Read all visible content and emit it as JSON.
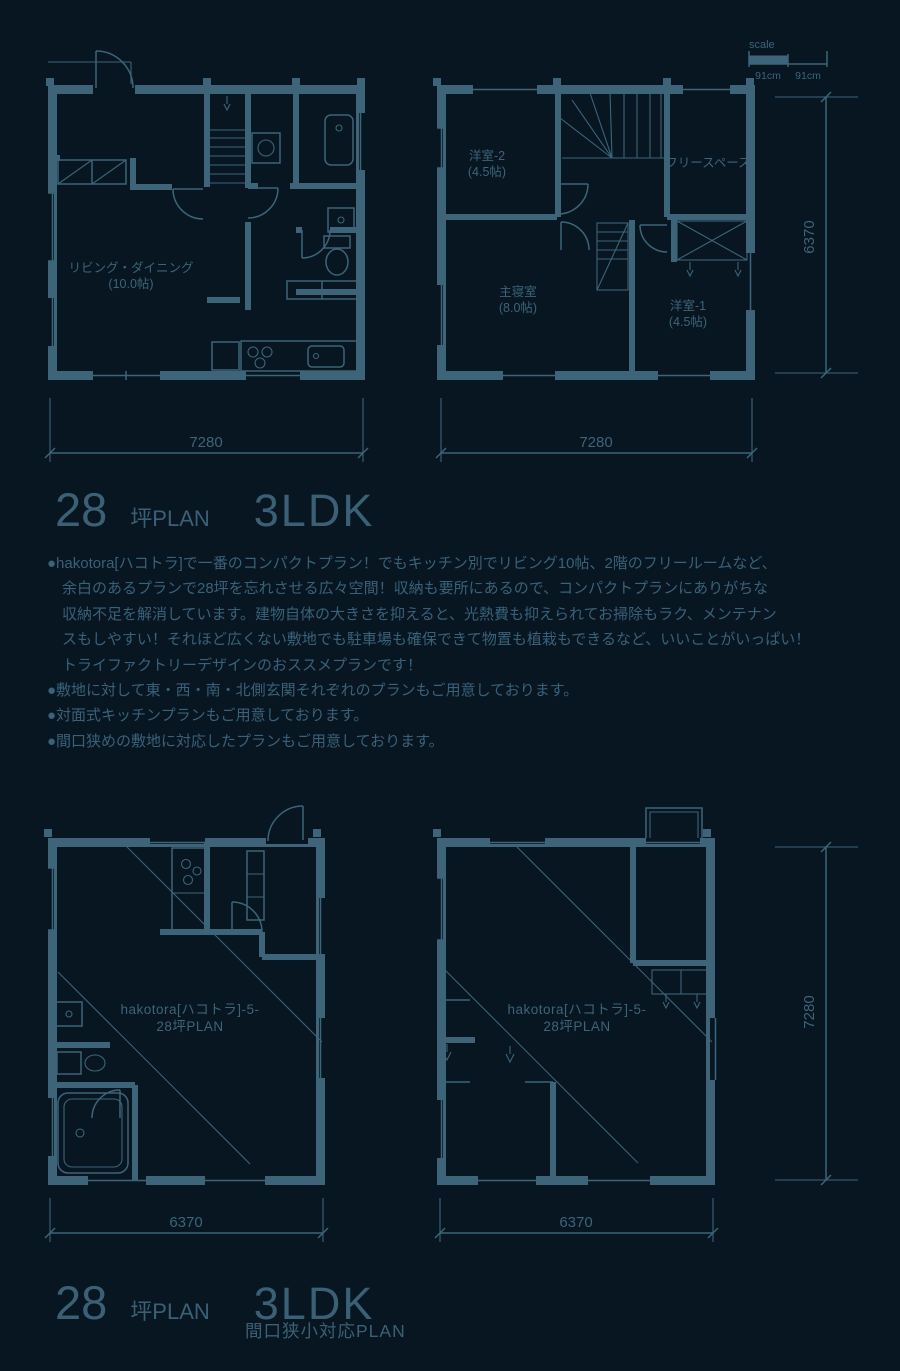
{
  "page": {
    "background": "#071621",
    "line_color": "#3D6479"
  },
  "scale_indicator": {
    "label": "scale",
    "segment1": "91cm",
    "segment2": "91cm"
  },
  "plan_1f": {
    "rooms": {
      "living": {
        "name": "リビング・ダイニング",
        "size": "(10.0帖)"
      }
    },
    "dim_width": "7280"
  },
  "plan_2f": {
    "rooms": {
      "bedroom2": {
        "name": "洋室-2",
        "size": "(4.5帖)"
      },
      "free_space": {
        "name": "フリースペース"
      },
      "master": {
        "name": "主寝室",
        "size": "(8.0帖)"
      },
      "bedroom1": {
        "name": "洋室-1",
        "size": "(4.5帖)"
      }
    },
    "dim_width": "7280",
    "dim_height": "6370"
  },
  "plan_narrow_1f": {
    "watermark_line1": "hakotora[ハコトラ]-5-",
    "watermark_line2": "28坪PLAN",
    "dim_width": "6370"
  },
  "plan_narrow_2f": {
    "watermark_line1": "hakotora[ハコトラ]-5-",
    "watermark_line2": "28坪PLAN",
    "dim_width": "6370",
    "dim_height": "7280"
  },
  "section_top": {
    "tsubo": "28",
    "tsubo_unit": "坪PLAN",
    "layout": "3LDK"
  },
  "description": {
    "lines": [
      "●hakotora[ハコトラ]で一番のコンパクトプラン！でもキッチン別でリビング10帖、2階のフリールームなど、",
      "余白のあるプランで28坪を忘れさせる広々空間！収納も要所にあるので、コンパクトプランにありがちな",
      "収納不足を解消しています。建物自体の大きさを抑えると、光熱費も抑えられてお掃除もラク、メンテナン",
      "スもしやすい！それほど広くない敷地でも駐車場も確保できて物置も植栽もできるなど、いいことがいっぱい！",
      "トライファクトリーデザインのおススメプランです！",
      "●敷地に対して東・西・南・北側玄関それぞれのプランもご用意しております。",
      "●対面式キッチンプランもご用意しております。",
      "●間口狭めの敷地に対応したプランもご用意しております。"
    ]
  },
  "section_bottom": {
    "tsubo": "28",
    "tsubo_unit": "坪PLAN",
    "layout": "3LDK",
    "subtitle": "間口狭小対応PLAN"
  }
}
